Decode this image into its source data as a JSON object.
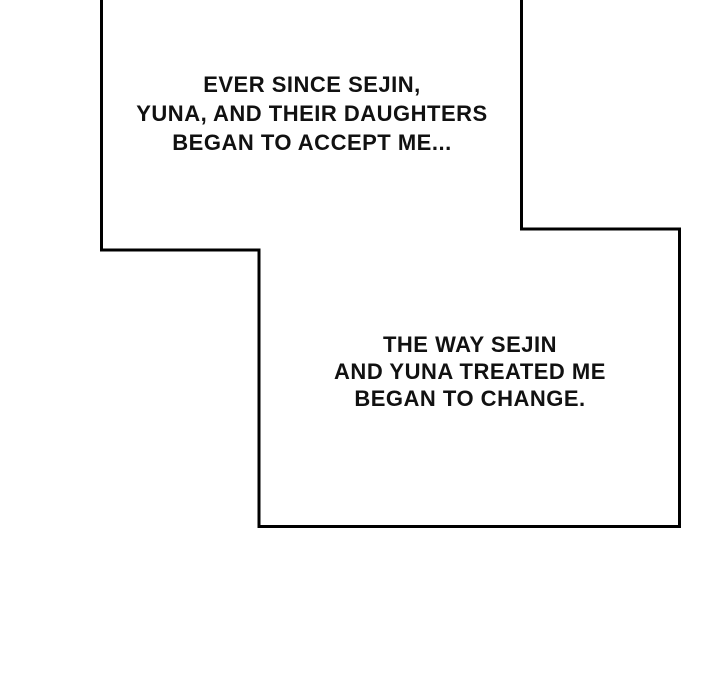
{
  "page": {
    "kind": "comic-panel-page",
    "colors": {
      "background": "#ffffff",
      "panel_fill": "#ffffff",
      "border_ink": "#000000",
      "text_ink": "#111111"
    }
  },
  "panels": {
    "top": {
      "caption": {
        "lines": [
          "EVER SINCE SEJIN,",
          "YUNA, AND THEIR DAUGHTERS",
          "BEGAN TO ACCEPT ME..."
        ]
      }
    },
    "bottom": {
      "caption": {
        "lines": [
          "THE WAY SEJIN",
          "AND YUNA TREATED ME",
          "BEGAN TO CHANGE."
        ]
      }
    }
  }
}
